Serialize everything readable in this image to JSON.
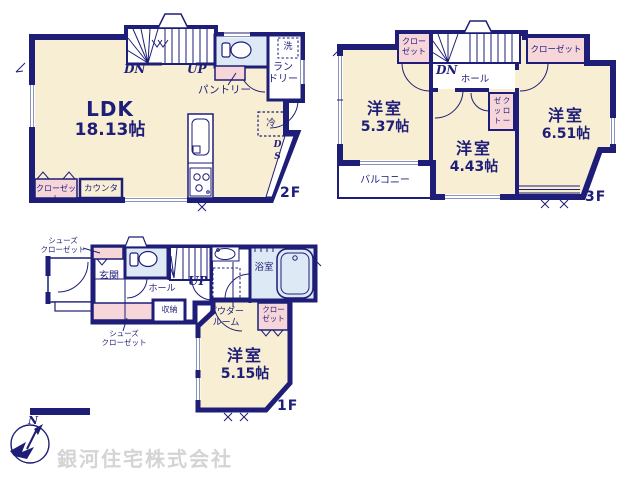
{
  "colors": {
    "wall": "#1e1e78",
    "room_cream": "#f8eed3",
    "closet_pink": "#f7d6da",
    "wet_area_blue": "#dde9f5",
    "window_line": "#8b93bd",
    "company_gray": "#d4d4d4"
  },
  "floor2": {
    "label": "2F",
    "ldk": {
      "name": "LDK",
      "size": "18.13帖"
    },
    "stairs_down": "DN",
    "stairs_up": "UP",
    "pantry": "パントリー",
    "laundry": {
      "line1": "ラン",
      "line2": "ドリー"
    },
    "washer": "洗",
    "fridge": "冷",
    "duct_space": "DS",
    "closet": "クローゼット",
    "counter": "カウンター"
  },
  "floor3": {
    "label": "3F",
    "stairs_down": "DN",
    "hall": "ホール",
    "closet_top_left": {
      "line1": "クロー",
      "line2": "ゼット"
    },
    "closet_top_right": "クローゼット",
    "closet_middle": {
      "line1": "クロー",
      "line2": "ゼット"
    },
    "rooms": [
      {
        "name": "洋室",
        "size": "5.37帖"
      },
      {
        "name": "洋室",
        "size": "4.43帖"
      },
      {
        "name": "洋室",
        "size": "6.51帖"
      }
    ],
    "balcony": "バルコニー"
  },
  "floor1": {
    "label": "1F",
    "stairs_up": "UP",
    "hall": "ホール",
    "entrance": "玄関",
    "storage": "収納",
    "shoes_closet_top": {
      "line1": "シューズ",
      "line2": "クローゼット"
    },
    "shoes_closet_bottom": {
      "line1": "シューズ",
      "line2": "クローゼット"
    },
    "powder_room": {
      "line1": "パウダー",
      "line2": "ルーム"
    },
    "bathroom": "浴室",
    "closet": {
      "line1": "クロー",
      "line2": "ゼット"
    },
    "room": {
      "name": "洋室",
      "size": "5.15帖"
    }
  },
  "footer": {
    "company": "銀河住宅株式会社",
    "compass_north": "N"
  }
}
